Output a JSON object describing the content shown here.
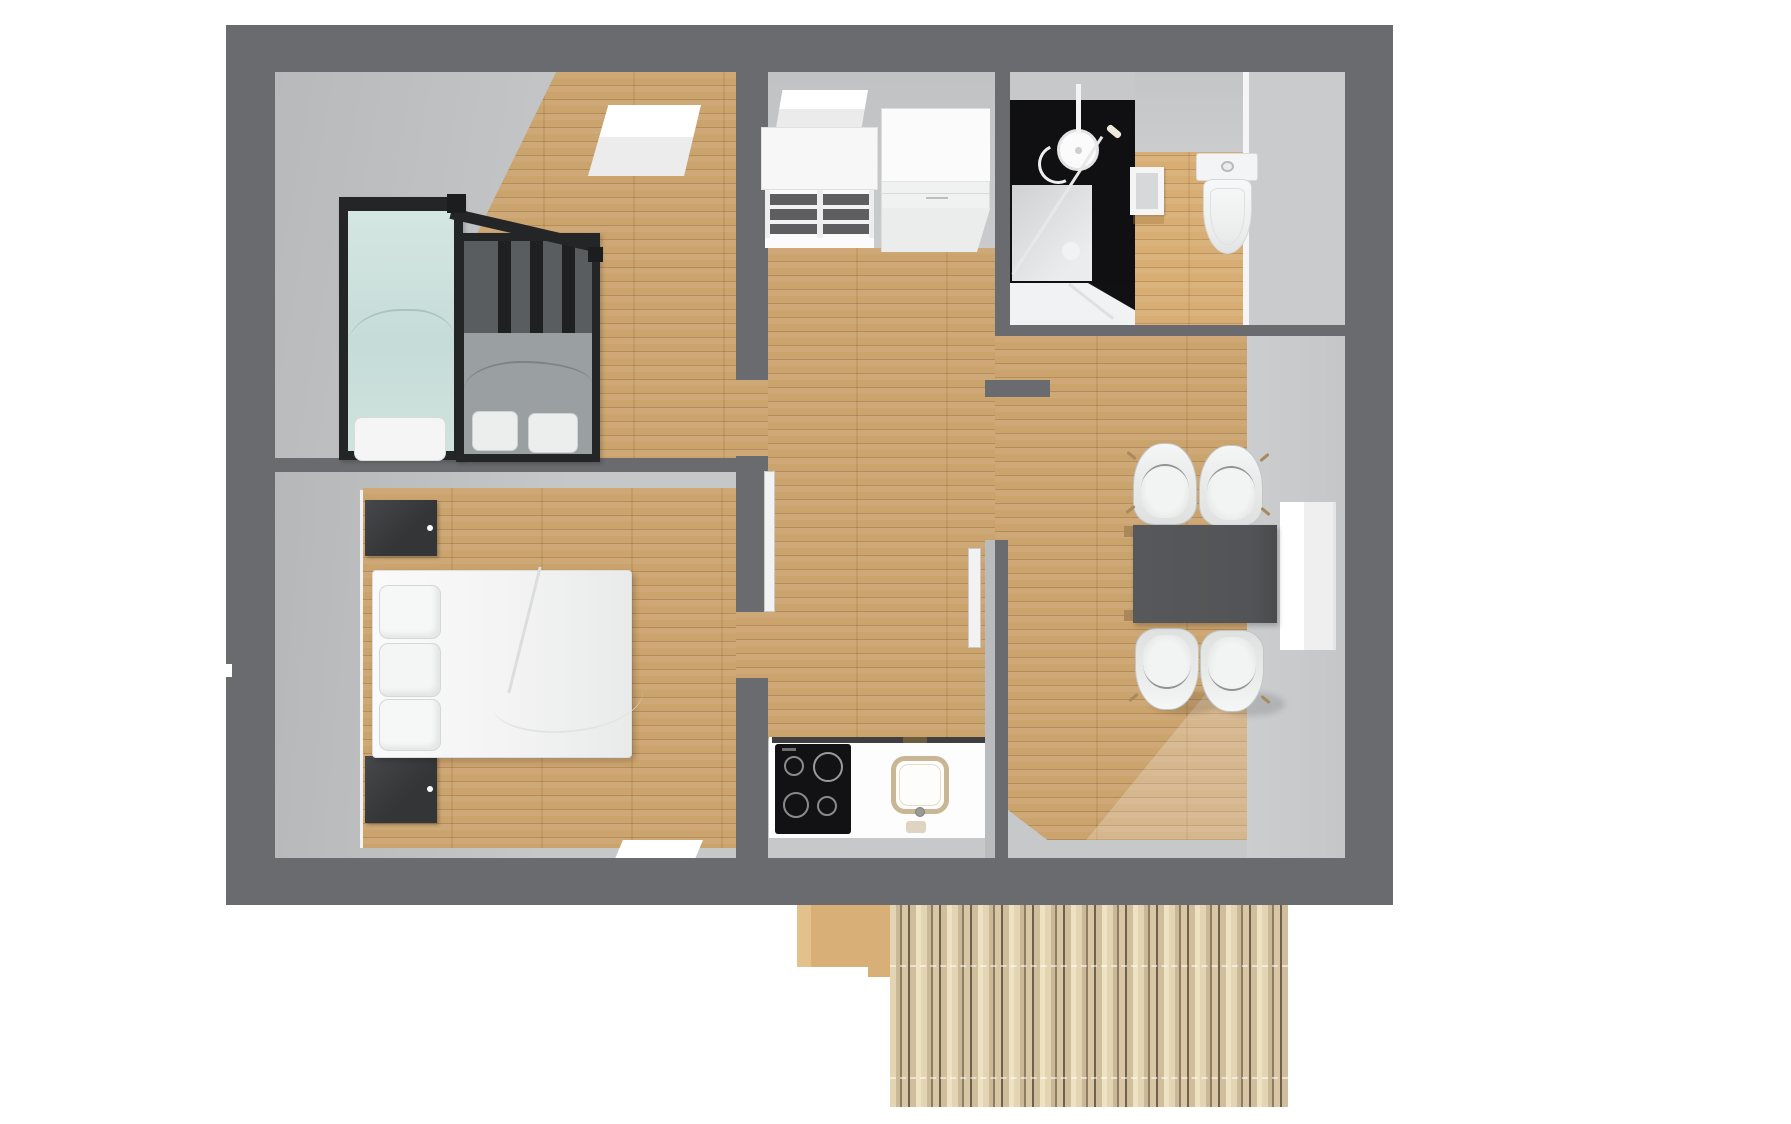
{
  "scene": {
    "kind": "3d-floorplan-top-view-render",
    "background_color": "#ffffff",
    "no_visible_text": true
  },
  "palette": {
    "outer_wall": "#696b6e",
    "inner_wall_face": "#c6c8ca",
    "wood_floor": "#c99f67",
    "deck_boards": "#d3c2a0",
    "shower_walls": "#101012",
    "furniture_white": "#f4f4f5",
    "table_gray": "#55575a",
    "nightstand_dark": "#38393b",
    "bedding_mint": "#c8dedb",
    "bedding_gray": "#9aa0a2"
  },
  "rooms": [
    {
      "name": "bedroom-twin",
      "location": "top-left",
      "furniture": [
        "single-bed-mint",
        "single-bed-gray",
        "skylight-window"
      ]
    },
    {
      "name": "bedroom-double",
      "location": "bottom-left",
      "furniture": [
        "double-bed-white",
        "nightstand-upper",
        "nightstand-lower",
        "window-bottom-wall"
      ]
    },
    {
      "name": "hall-kitchen",
      "location": "center",
      "furniture": [
        "cube-shelf",
        "wardrobe",
        "window-top-wall",
        "kitchen-counter",
        "cooktop",
        "sink"
      ]
    },
    {
      "name": "bathroom",
      "location": "top-right",
      "furniture": [
        "shower-black",
        "shower-head",
        "wall-niche",
        "toilet"
      ]
    },
    {
      "name": "storage",
      "location": "top-right-corner",
      "furniture": []
    },
    {
      "name": "dining-room",
      "location": "right",
      "furniture": [
        "dining-table",
        "chair-top-left",
        "chair-top-right",
        "chair-bottom-left",
        "chair-bottom-right",
        "window-right-wall"
      ]
    },
    {
      "name": "deck",
      "location": "bottom-outside",
      "furniture": [
        "deck-step",
        "deck-boards"
      ]
    }
  ],
  "doors": [
    {
      "name": "door-bedroom-double",
      "state": "open",
      "leaf_color": "#f2f2f2"
    },
    {
      "name": "door-kitchen-dining",
      "state": "open",
      "leaf_color": "#f2f2f2"
    }
  ],
  "counts": {
    "chairs": 4,
    "beds": 3,
    "nightstands": 2,
    "cooktop_burners": 4
  }
}
